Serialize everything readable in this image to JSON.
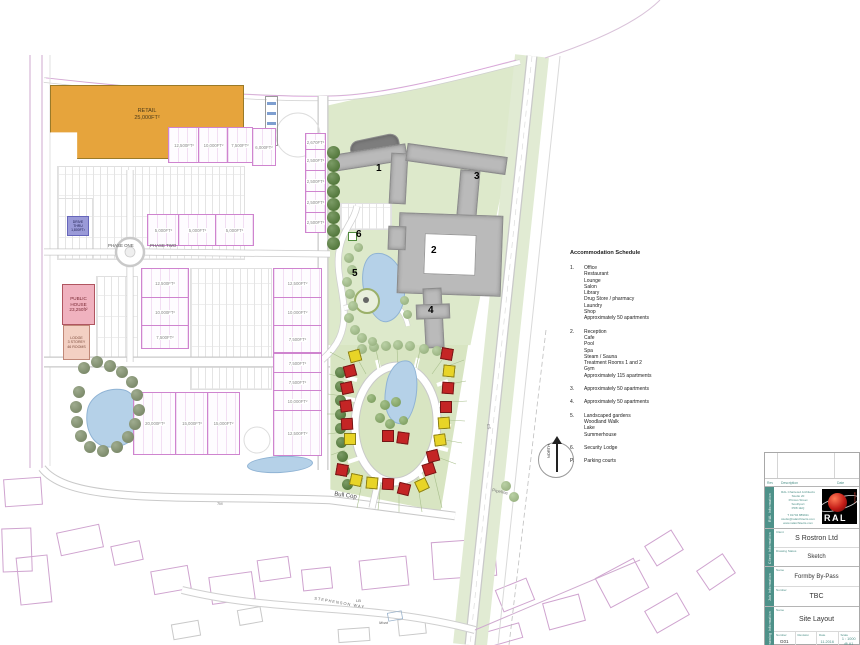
{
  "schedule": {
    "title": "Accommodation Schedule",
    "items": [
      {
        "num": "1.",
        "lines": [
          "Office",
          "Restaurant",
          "Lounge",
          "Salon",
          "Library",
          "Drug Store / pharmacy",
          "Laundry",
          "Shop",
          "Approximately 50 apartments"
        ]
      },
      {
        "num": "2.",
        "lines": [
          "Reception",
          "Cafe",
          "Pool",
          "Spa",
          "Steam / Sauna",
          "Treatment Rooms 1 and 2",
          "Gym",
          "Approximately 115 apartments"
        ]
      },
      {
        "num": "3.",
        "lines": [
          "Approximately 50 apartments"
        ]
      },
      {
        "num": "4.",
        "lines": [
          "Approximately 50 apartments"
        ]
      },
      {
        "num": "5.",
        "lines": [
          "Landscaped gardens",
          "Woodland Walk",
          "Lake",
          "Summerhouse"
        ]
      },
      {
        "num": "6.",
        "lines": [
          "Security Lodge"
        ]
      },
      {
        "num": "P.",
        "lines": [
          "Parking courts"
        ]
      }
    ]
  },
  "titleblock": {
    "rev_header": {
      "rev": "Rev",
      "description": "Description",
      "date": "Date"
    },
    "sections": {
      "ral": {
        "label": "RAL Information",
        "address_lines": [
          "RAL Chartered Architects",
          "Studio 20",
          "Princes Street",
          "Southport",
          "PR8 1EQ",
          "T 01704 889911",
          "studio@ralarchitects.com",
          "www.ralarchitects.com"
        ],
        "logo_text": "RAL",
        "logo_sub": "architects"
      },
      "client": {
        "label": "Client Information",
        "client_label": "Client",
        "client_value": "S Rostron Ltd",
        "status_label": "Drawing Status",
        "status_value": "Sketch"
      },
      "job": {
        "label": "Job Information",
        "name_label": "Name",
        "name_value": "Formby By-Pass",
        "number_label": "Number",
        "number_value": "TBC"
      },
      "drawing": {
        "label": "Drawing Information",
        "name_label": "Name",
        "name_value": "Site Layout",
        "number_label": "Number",
        "number_value": "G01",
        "revision_label": "Revision",
        "revision_value": "",
        "date_label": "Date",
        "date_value": "11.2016",
        "scale_label": "Scale",
        "scale_value": "1 : 1000",
        "scale_value2": "@ A1"
      }
    }
  },
  "map": {
    "labels": {
      "retail": "RETAIL\n25,000FT²",
      "public_house": "PUBLIC\nHOUSE\n23,250ft²",
      "lodge": "LODGE\n3 STOREY\n46 ROOMS",
      "drive_thru": "DRIVE\nTHRU\n1,800FT²",
      "phase_one": "PHASE ONE",
      "phase_two": "PHASE TWO",
      "bull_cop": "Bull Cop",
      "stephenson_way": "STEPHENSON WAY",
      "pipeline": "Pipeline",
      "moat": "Moat",
      "lb": "LB",
      "cs": "CS",
      "seven_m": "7M",
      "north": "NORTH",
      "n1": "1",
      "n2": "2",
      "n3": "3",
      "n4": "4",
      "n5": "5",
      "n6": "6"
    },
    "palette": {
      "site_green": "#dde9cb",
      "tree_dark": "#4f7a33",
      "tree_mid": "#85ab62",
      "tree_light": "#a3c187",
      "tree_olive": "#7f906a",
      "house_red": "#c42525",
      "house_yellow": "#e8d427",
      "unit_magenta": "#cf84cf",
      "lake_blue": "#b5d1e8",
      "teal": "#4e9189",
      "retail_orange": "#e6a43c",
      "pub_pink": "#f0b2bf"
    },
    "units": [
      [
        168,
        127,
        30,
        34,
        "12,500FT²"
      ],
      [
        198,
        127,
        29,
        34,
        "10,000FT²"
      ],
      [
        227,
        127,
        24,
        34,
        "7,500FT²"
      ],
      [
        252,
        128,
        22,
        36,
        "6,000FT²"
      ],
      [
        305,
        133,
        19,
        16,
        "2,670FT²"
      ],
      [
        305,
        149,
        19,
        21,
        "2,500FT²"
      ],
      [
        305,
        170,
        19,
        21,
        "2,500FT²"
      ],
      [
        305,
        191,
        19,
        21,
        "2,500FT²"
      ],
      [
        305,
        212,
        19,
        19,
        "2,500FT²"
      ],
      [
        141,
        268,
        46,
        29,
        "12,500FT²"
      ],
      [
        141,
        297,
        46,
        28,
        "10,000FT²"
      ],
      [
        141,
        325,
        46,
        22,
        "7,500FT²"
      ],
      [
        273,
        268,
        47,
        29,
        "12,500FT²"
      ],
      [
        273,
        297,
        47,
        28,
        "10,000FT²"
      ],
      [
        273,
        325,
        47,
        26,
        "7,500FT²"
      ],
      [
        273,
        353,
        47,
        19,
        "7,500FT²"
      ],
      [
        273,
        372,
        47,
        18,
        "7,500FT²"
      ],
      [
        273,
        390,
        47,
        20,
        "10,000FT²"
      ],
      [
        273,
        410,
        47,
        44,
        "12,500FT²"
      ],
      [
        133,
        392,
        42,
        61,
        "20,000FT²"
      ],
      [
        175,
        392,
        32,
        61,
        "15,000FT²"
      ],
      [
        207,
        392,
        31,
        61,
        "15,000FT²"
      ],
      [
        147,
        214,
        31,
        30,
        "5,000FT²"
      ],
      [
        178,
        214,
        37,
        30,
        "5,000FT²"
      ],
      [
        215,
        214,
        37,
        30,
        "5,000FT²"
      ]
    ],
    "parking": [
      [
        57,
        166,
        186,
        92
      ],
      [
        96,
        276,
        40,
        82
      ],
      [
        190,
        268,
        80,
        120
      ],
      [
        340,
        203,
        50,
        25
      ],
      [
        57,
        198,
        34,
        60
      ]
    ],
    "os_outlines": [
      [
        58,
        528,
        42,
        22,
        -12,
        "m"
      ],
      [
        112,
        543,
        28,
        18,
        -12,
        "m"
      ],
      [
        18,
        556,
        30,
        46,
        -6,
        "m"
      ],
      [
        152,
        568,
        36,
        22,
        -10,
        "m"
      ],
      [
        210,
        574,
        42,
        26,
        -8,
        "m"
      ],
      [
        258,
        558,
        30,
        20,
        -8,
        "m"
      ],
      [
        302,
        568,
        28,
        20,
        -6,
        "m"
      ],
      [
        360,
        558,
        46,
        28,
        -6,
        "m"
      ],
      [
        432,
        540,
        62,
        36,
        -4,
        "m"
      ],
      [
        498,
        583,
        32,
        22,
        -22,
        "m"
      ],
      [
        545,
        598,
        36,
        26,
        -15,
        "m"
      ],
      [
        600,
        566,
        42,
        32,
        -28,
        "m"
      ],
      [
        648,
        536,
        30,
        22,
        -32,
        "m"
      ],
      [
        398,
        618,
        26,
        15,
        -6,
        "g"
      ],
      [
        338,
        628,
        30,
        12,
        -4,
        "g"
      ],
      [
        478,
        628,
        42,
        14,
        -16,
        "m"
      ],
      [
        238,
        608,
        22,
        14,
        -10,
        "g"
      ],
      [
        172,
        622,
        26,
        14,
        -10,
        "g"
      ],
      [
        4,
        478,
        36,
        26,
        -4,
        "m"
      ],
      [
        2,
        528,
        28,
        42,
        -2,
        "m"
      ],
      [
        648,
        600,
        36,
        24,
        -30,
        "m"
      ],
      [
        700,
        560,
        30,
        22,
        -34,
        "m"
      ]
    ],
    "houses": [
      [
        355,
        356,
        "y",
        -15
      ],
      [
        350,
        371,
        "r",
        -15
      ],
      [
        347,
        388,
        "r",
        -12
      ],
      [
        346,
        406,
        "r",
        -8
      ],
      [
        347,
        424,
        "r",
        -3
      ],
      [
        350,
        439,
        "y",
        0
      ],
      [
        342,
        470,
        "r",
        10
      ],
      [
        356,
        480,
        "y",
        12
      ],
      [
        372,
        483,
        "y",
        5
      ],
      [
        388,
        484,
        "r",
        3
      ],
      [
        404,
        489,
        "r",
        14
      ],
      [
        422,
        485,
        "y",
        -25
      ],
      [
        447,
        354,
        "r",
        10
      ],
      [
        449,
        371,
        "y",
        6
      ],
      [
        448,
        388,
        "r",
        4
      ],
      [
        446,
        407,
        "r",
        0
      ],
      [
        444,
        423,
        "y",
        -4
      ],
      [
        440,
        440,
        "y",
        -8
      ],
      [
        433,
        456,
        "r",
        -14
      ],
      [
        429,
        469,
        "r",
        -18
      ],
      [
        388,
        436,
        "r",
        0
      ],
      [
        403,
        438,
        "r",
        8
      ]
    ],
    "trees": [
      [
        333,
        152,
        6.5,
        "d"
      ],
      [
        333,
        165,
        6.5,
        "d"
      ],
      [
        333,
        178,
        6.5,
        "d"
      ],
      [
        333,
        191,
        6.5,
        "d"
      ],
      [
        333,
        204,
        6.5,
        "d"
      ],
      [
        333,
        217,
        6.5,
        "d"
      ],
      [
        333,
        230,
        6.5,
        "d"
      ],
      [
        333,
        243,
        6.5,
        "d"
      ],
      [
        340,
        372,
        5.5,
        "d"
      ],
      [
        340,
        386,
        5.5,
        "d"
      ],
      [
        340,
        400,
        5.5,
        "d"
      ],
      [
        340,
        414,
        5.5,
        "d"
      ],
      [
        340,
        428,
        5.5,
        "d"
      ],
      [
        341,
        442,
        5.5,
        "d"
      ],
      [
        342,
        456,
        5.5,
        "d"
      ],
      [
        344,
        470,
        5.5,
        "d"
      ],
      [
        347,
        484,
        5.5,
        "d"
      ],
      [
        362,
        349,
        5,
        "l"
      ],
      [
        374,
        347,
        5,
        "l"
      ],
      [
        386,
        346,
        5,
        "l"
      ],
      [
        398,
        345,
        5,
        "l"
      ],
      [
        410,
        346,
        5,
        "l"
      ],
      [
        424,
        349,
        5,
        "l"
      ],
      [
        437,
        351,
        5,
        "l"
      ],
      [
        349,
        258,
        5,
        "l"
      ],
      [
        352,
        270,
        5,
        "l"
      ],
      [
        347,
        282,
        5,
        "l"
      ],
      [
        350,
        294,
        5,
        "l"
      ],
      [
        353,
        306,
        5,
        "l"
      ],
      [
        349,
        318,
        5,
        "l"
      ],
      [
        355,
        330,
        5,
        "l"
      ],
      [
        362,
        338,
        5,
        "l"
      ],
      [
        372,
        341,
        4.5,
        "l"
      ],
      [
        358,
        247,
        4.5,
        "l"
      ],
      [
        404,
        300,
        4.5,
        "l"
      ],
      [
        407,
        314,
        4.5,
        "l"
      ],
      [
        385,
        405,
        5,
        "m"
      ],
      [
        396,
        402,
        5,
        "m"
      ],
      [
        380,
        418,
        5,
        "m"
      ],
      [
        390,
        424,
        5,
        "m"
      ],
      [
        403,
        420,
        4.5,
        "m"
      ],
      [
        371,
        398,
        4.5,
        "m"
      ],
      [
        84,
        368,
        6,
        "o"
      ],
      [
        97,
        362,
        6,
        "o"
      ],
      [
        110,
        366,
        6,
        "o"
      ],
      [
        122,
        372,
        6,
        "o"
      ],
      [
        132,
        382,
        6,
        "o"
      ],
      [
        137,
        395,
        6,
        "o"
      ],
      [
        139,
        410,
        6,
        "o"
      ],
      [
        135,
        424,
        6,
        "o"
      ],
      [
        128,
        437,
        6,
        "o"
      ],
      [
        117,
        447,
        6,
        "o"
      ],
      [
        103,
        451,
        6,
        "o"
      ],
      [
        90,
        447,
        6,
        "o"
      ],
      [
        81,
        436,
        6,
        "o"
      ],
      [
        77,
        422,
        6,
        "o"
      ],
      [
        76,
        407,
        6,
        "o"
      ],
      [
        79,
        392,
        6,
        "o"
      ],
      [
        506,
        486,
        5,
        "l"
      ],
      [
        514,
        497,
        5,
        "l"
      ]
    ]
  }
}
